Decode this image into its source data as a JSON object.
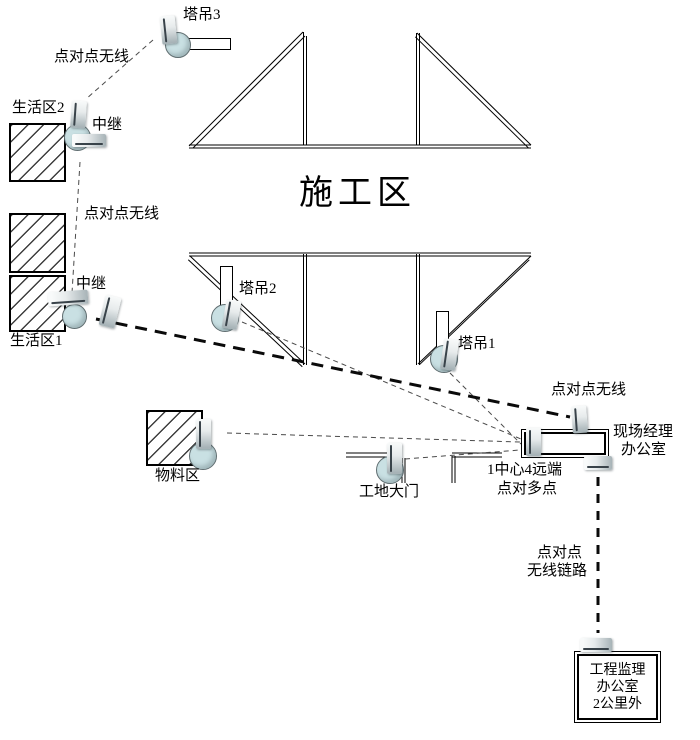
{
  "diagram": {
    "title": "施工区",
    "cranes": {
      "crane3_label": "塔吊3",
      "crane2_label": "塔吊2",
      "crane1_label": "塔吊1"
    },
    "areas": {
      "living2_label": "生活区2",
      "living1_label": "生活区1",
      "materials_label": "物料区",
      "gate_label": "工地大门"
    },
    "relays": {
      "relay_upper_label": "中继",
      "relay_lower_label": "中继"
    },
    "links": {
      "p2p_top_label": "点对点无线",
      "p2p_mid_label": "点对点无线",
      "p2p_office_label": "点对点无线",
      "p2mp_line1": "1中心4远端",
      "p2mp_line2": "点对多点",
      "backhaul_line1": "点对点",
      "backhaul_line2": "无线链路"
    },
    "offices": {
      "site_manager_line1": "现场经理",
      "site_manager_line2": "办公室",
      "supervision_line1": "工程监理",
      "supervision_line2": "办公室",
      "supervision_line3": "2公里外"
    }
  },
  "colors": {
    "background": "#ffffff",
    "line": "#000000",
    "thin_dash": "#4a4a4a",
    "device_fill": "#c9e0e3",
    "antenna_gray": "#a7b3b7"
  }
}
